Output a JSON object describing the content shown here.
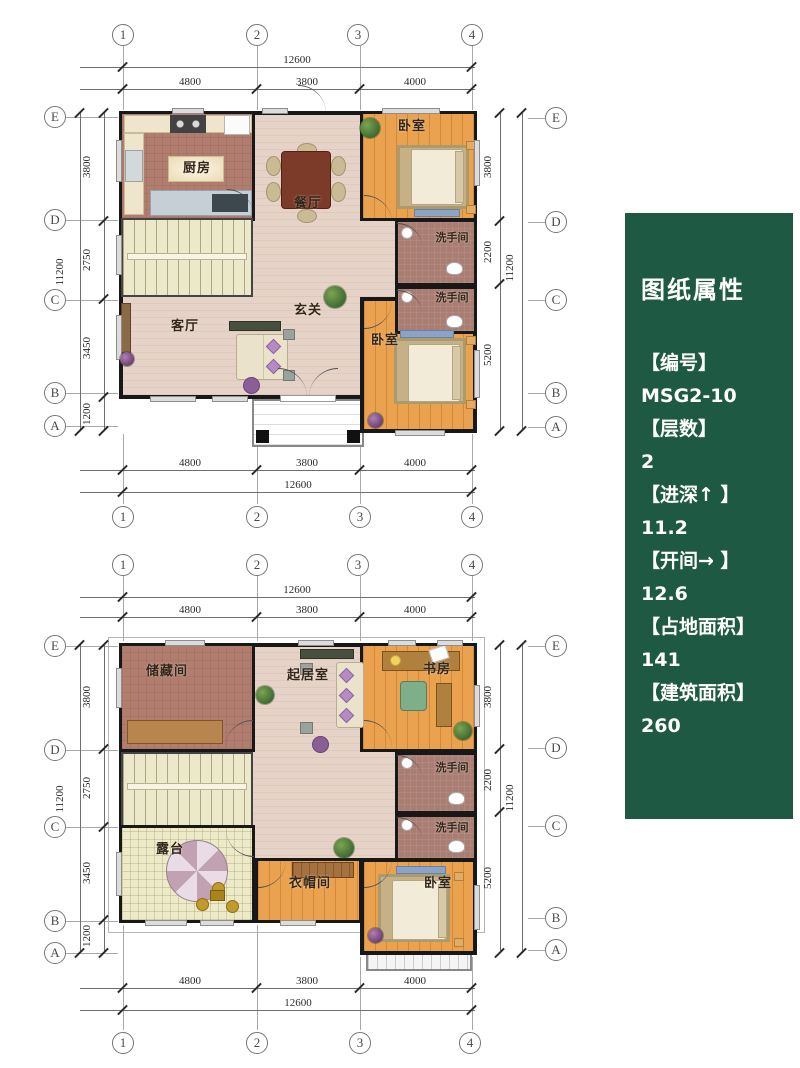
{
  "panel": {
    "title": "图纸属性",
    "bg_color": "#1e5a43",
    "items": [
      {
        "label": "【编号】",
        "value": "MSG2-10"
      },
      {
        "label": "【层数】",
        "value": "2"
      },
      {
        "label": "【进深↑ 】",
        "value": "11.2"
      },
      {
        "label": "【开间→ 】",
        "value": "12.6"
      },
      {
        "label": "【占地面积】",
        "value": "141"
      },
      {
        "label": "【建筑面积】",
        "value": "260"
      }
    ]
  },
  "plan1": {
    "axes": {
      "t1": "1",
      "t2": "2",
      "t3": "3",
      "t4": "4",
      "b1": "1",
      "b2": "2",
      "b3": "3",
      "b4": "4",
      "lE": "E",
      "lD": "D",
      "lC": "C",
      "lB": "B",
      "lA": "A",
      "rE": "E",
      "rD": "D",
      "rC": "C",
      "rB": "B",
      "rA": "A"
    },
    "dims": {
      "w_total": "12600",
      "w1": "4800",
      "w2": "3800",
      "w3": "4000",
      "wb_total": "12600",
      "wb1": "4800",
      "wb2": "3800",
      "wb3": "4000",
      "h_total": "11200",
      "hl1": "3800",
      "hl2": "2750",
      "hl3": "3450",
      "hl4": "1200",
      "hr_total": "11200",
      "hr1": "3800",
      "hr2": "2200",
      "hr3": "5200"
    },
    "rooms": {
      "kitchen": "厨房",
      "dining": "餐厅",
      "bedroom1": "卧室",
      "bath1": "洗手间",
      "bath2": "洗手间",
      "hall": "玄关",
      "living": "客厅",
      "bedroom2": "卧室"
    }
  },
  "plan2": {
    "axes": {
      "t1": "1",
      "t2": "2",
      "t3": "3",
      "t4": "4",
      "b1": "1",
      "b2": "2",
      "b3": "3",
      "b4": "4",
      "lE": "E",
      "lD": "D",
      "lC": "C",
      "lB": "B",
      "lA": "A",
      "rE": "E",
      "rD": "D",
      "rC": "C",
      "rB": "B",
      "rA": "A"
    },
    "dims": {
      "w_total": "12600",
      "w1": "4800",
      "w2": "3800",
      "w3": "4000",
      "wb_total": "12600",
      "wb1": "4800",
      "wb2": "3800",
      "wb3": "4000",
      "h_total": "11200",
      "hl1": "3800",
      "hl2": "2750",
      "hl3": "3450",
      "hl4": "1200",
      "hr_total": "11200",
      "hr1": "3800",
      "hr2": "2200",
      "hr3": "5200"
    },
    "rooms": {
      "storage": "储藏间",
      "sitting": "起居室",
      "study": "书房",
      "bath1": "洗手间",
      "bath2": "洗手间",
      "terrace": "露台",
      "cloak": "衣帽间",
      "bedroom": "卧室"
    }
  }
}
